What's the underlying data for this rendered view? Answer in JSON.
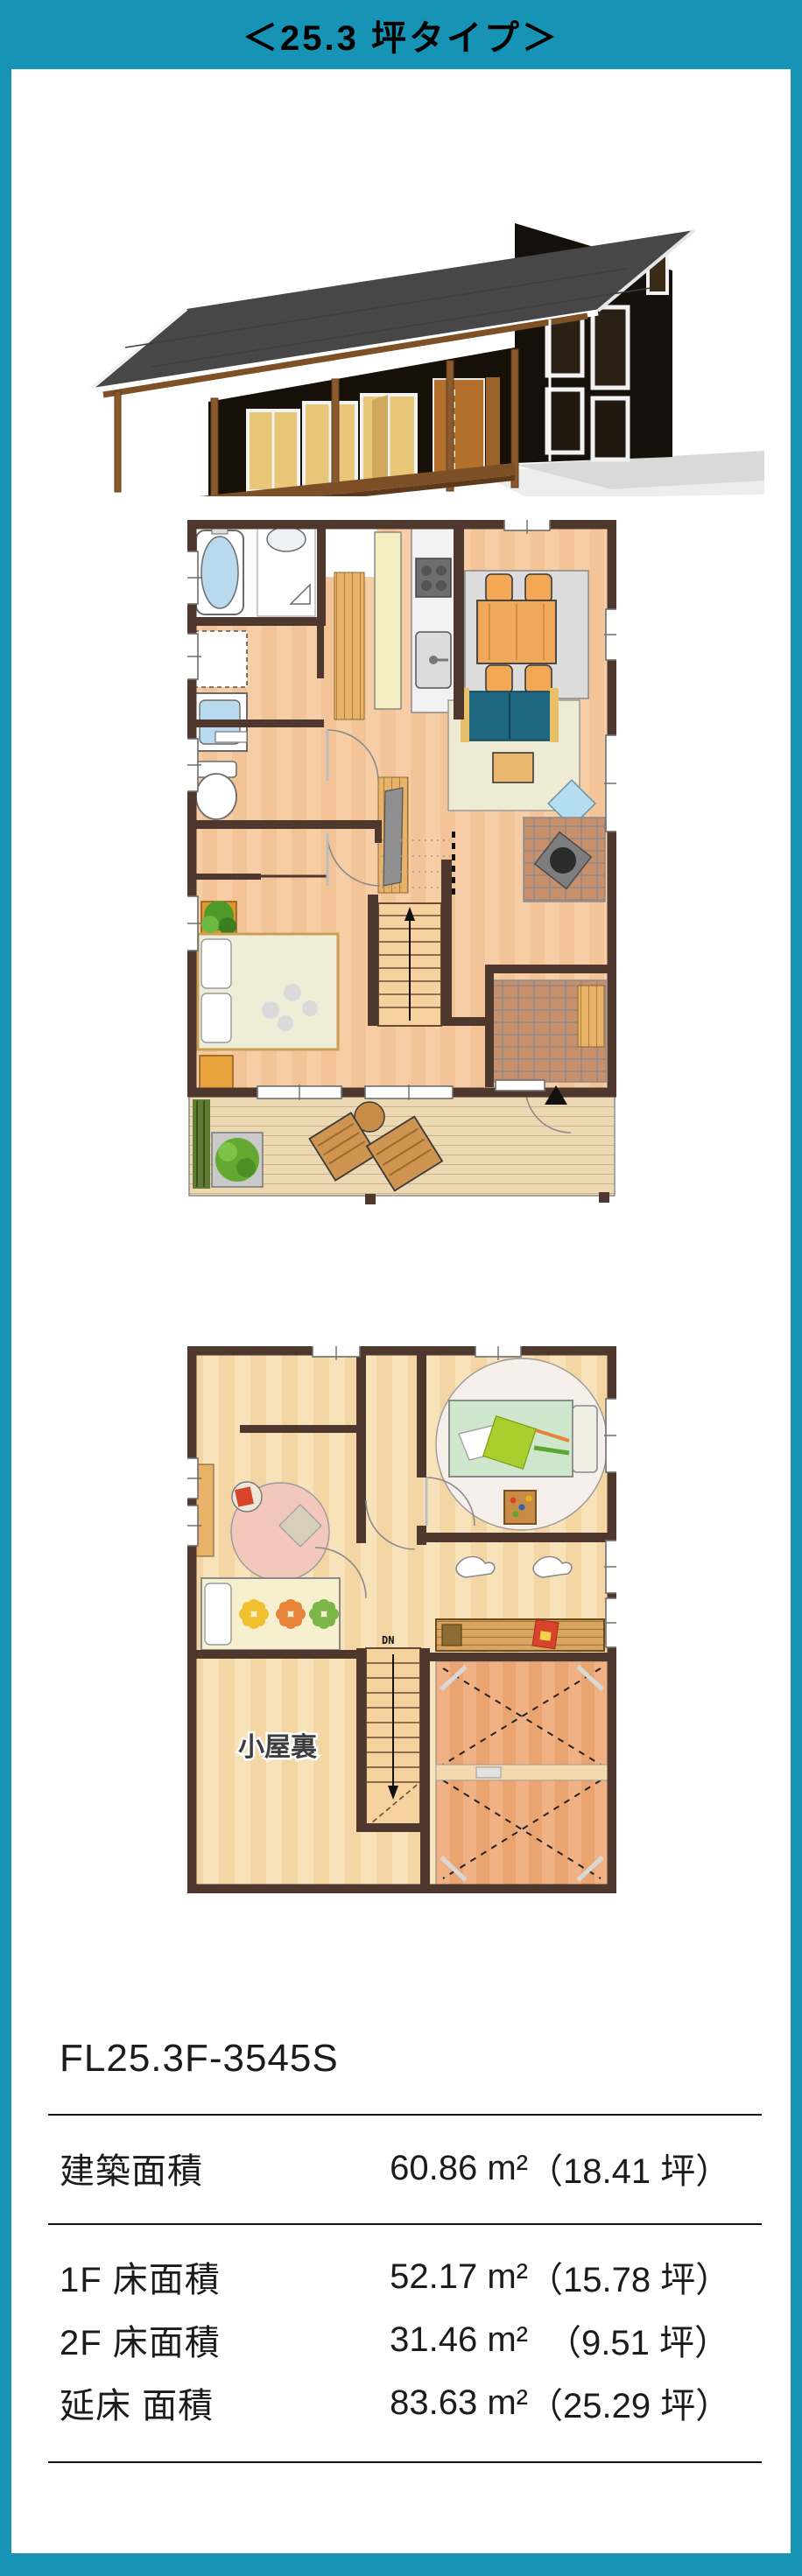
{
  "frame": {
    "title": "＜25.3 坪タイプ＞",
    "accent_color": "#1794b5",
    "wall_color": "#4e372c",
    "floor_color": "#f3c498"
  },
  "floor_plans": {
    "attic_label": "小屋裏",
    "stairs_down_label": "DN"
  },
  "model": {
    "name": "FL25.3F-3545S"
  },
  "specs": {
    "building": {
      "label": "建築面積",
      "sqm": "60.86 m²",
      "tsubo": "（18.41 坪）"
    },
    "f1": {
      "label": "1F 床面積",
      "sqm": "52.17 m²",
      "tsubo": "（15.78 坪）"
    },
    "f2": {
      "label": "2F 床面積",
      "sqm": "31.46 m²",
      "tsubo": "（9.51 坪）"
    },
    "total": {
      "label": "延床 面積",
      "sqm": "83.63 m²",
      "tsubo": "（25.29 坪）"
    }
  }
}
